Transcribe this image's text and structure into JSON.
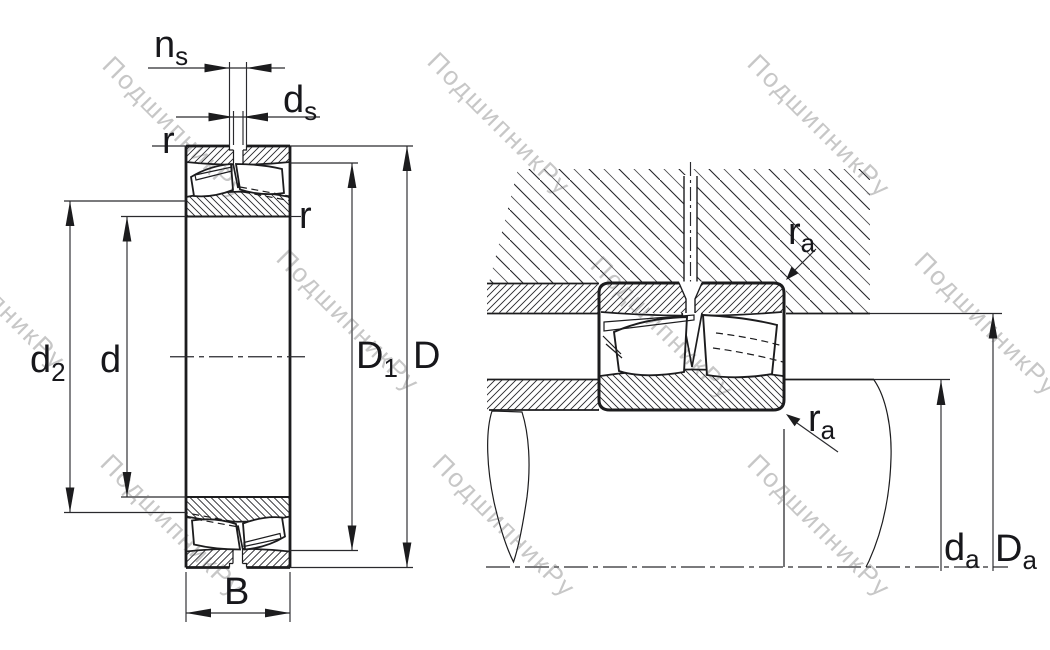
{
  "watermark": {
    "text": "ПодшипникРу"
  },
  "left_view": {
    "labels": {
      "ns": {
        "base": "n",
        "sub": "s"
      },
      "ds": {
        "base": "d",
        "sub": "s"
      },
      "r_top": {
        "base": "r"
      },
      "r_right": {
        "base": "r"
      },
      "d2": {
        "base": "d",
        "sub": "2"
      },
      "d": {
        "base": "d"
      },
      "D1": {
        "base": "D",
        "sub": "1"
      },
      "D": {
        "base": "D"
      },
      "B": {
        "base": "B"
      }
    }
  },
  "right_view": {
    "labels": {
      "ra_top": {
        "base": "r",
        "sub": "a"
      },
      "ra_bottom": {
        "base": "r",
        "sub": "a"
      },
      "da": {
        "base": "d",
        "sub": "a"
      },
      "Da": {
        "base": "D",
        "sub": "a"
      }
    }
  },
  "colors": {
    "line": "#1c1c1e",
    "dim_line": "#2a2a2e",
    "label": "#17171b",
    "watermark": "#c7c7c7",
    "background": "#ffffff"
  }
}
